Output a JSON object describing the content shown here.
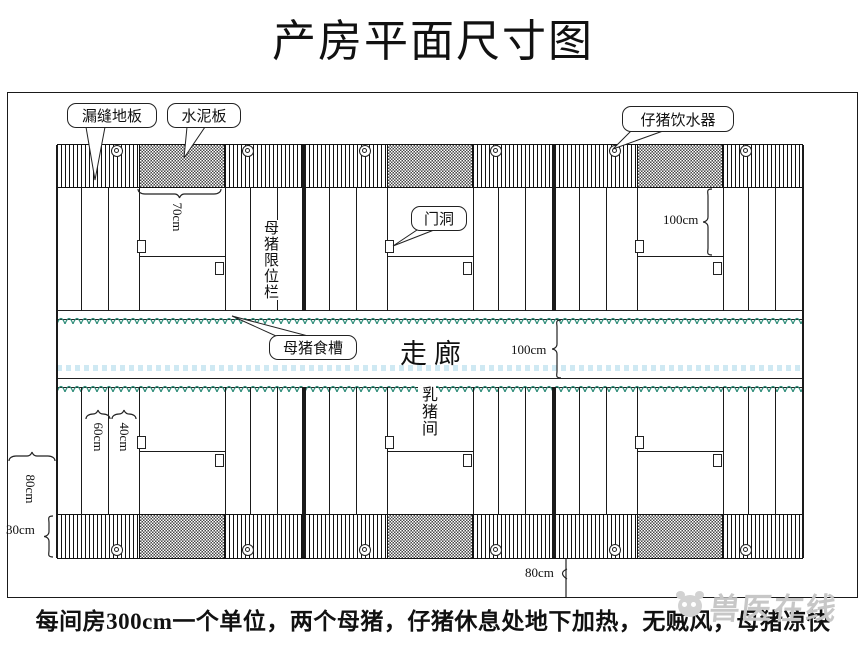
{
  "title": "产房平面尺寸图",
  "caption": "每间房300cm一个单位，两个母猪，仔猪休息处地下加热，无贼风，母猪凉快",
  "watermark": {
    "text": "兽医在线"
  },
  "callouts": {
    "slatted_floor": "漏缝地板",
    "cement_board": "水泥板",
    "piglet_drinker": "仔猪饮水器",
    "door_opening": "门洞",
    "sow_feed_trough": "母猪食槽"
  },
  "room_labels": {
    "corridor": "走廊",
    "sow_crate": "母猪限位栏",
    "piglet_room": "乳猪间"
  },
  "dimensions": {
    "creep_board_width": "70cm",
    "crate_front_length": "100cm",
    "corridor_width": "100cm",
    "stall_width_60": "60cm",
    "stall_width_40": "40cm",
    "side_walkway": "80cm",
    "outer_strip": "30cm",
    "end_walkway": "80cm"
  },
  "colors": {
    "trough_teal": "#2e8d79",
    "corridor_dots": "#cfe9f3",
    "watermark_gray": "#c7c7c7",
    "line": "#1a1a1a"
  }
}
